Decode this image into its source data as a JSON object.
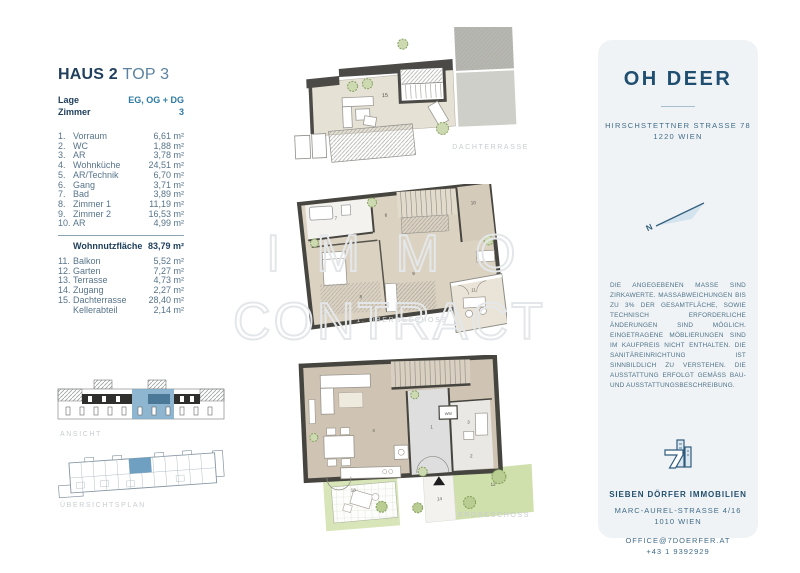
{
  "unit": {
    "title_main": "HAUS 2",
    "title_sub": "TOP 3",
    "info": [
      {
        "label": "Lage",
        "value": "EG, OG + DG"
      },
      {
        "label": "Zimmer",
        "value": "3"
      }
    ],
    "rooms": [
      {
        "no": "1.",
        "name": "Vorraum",
        "area": "6,61 m²"
      },
      {
        "no": "2.",
        "name": "WC",
        "area": "1,88 m²"
      },
      {
        "no": "3.",
        "name": "AR",
        "area": "3,78 m²"
      },
      {
        "no": "4.",
        "name": "Wohnküche",
        "area": "24,51 m²"
      },
      {
        "no": "5.",
        "name": "AR/Technik",
        "area": "6,70 m²"
      },
      {
        "no": "6.",
        "name": "Gang",
        "area": "3,71 m²"
      },
      {
        "no": "7.",
        "name": "Bad",
        "area": "3,89 m²"
      },
      {
        "no": "8.",
        "name": "Zimmer 1",
        "area": "11,19 m²"
      },
      {
        "no": "9.",
        "name": "Zimmer 2",
        "area": "16,53 m²"
      },
      {
        "no": "10.",
        "name": "AR",
        "area": "4,99 m²"
      }
    ],
    "total": {
      "label": "Wohnnutzfläche",
      "area": "83,79 m²"
    },
    "outdoor": [
      {
        "no": "11.",
        "name": "Balkon",
        "area": "5,52 m²"
      },
      {
        "no": "12.",
        "name": "Garten",
        "area": "7,27 m²"
      },
      {
        "no": "13.",
        "name": "Terrasse",
        "area": "4,73 m²"
      },
      {
        "no": "14.",
        "name": "Zugang",
        "area": "2,27 m²"
      },
      {
        "no": "15.",
        "name": "Dachterrasse",
        "area": "28,40 m²"
      },
      {
        "no": "",
        "name": "Kellerabteil",
        "area": "2,14 m²"
      }
    ]
  },
  "drawings": {
    "ansicht_caption": "ANSICHT",
    "uebersichtsplan_caption": "ÜBERSICHTSPLAN"
  },
  "plans": {
    "dachterrasse": {
      "caption": "DACHTERRASSE",
      "labels": [
        "15"
      ]
    },
    "obergeschoss": {
      "caption": "1. OBERGESCHOSS",
      "labels": [
        "6",
        "7",
        "8",
        "9",
        "10",
        "11"
      ]
    },
    "erdgeschoss": {
      "caption": "ERDGESCHOSS",
      "labels": [
        "4",
        "1",
        "3",
        "2",
        "WM",
        "13",
        "14",
        "12"
      ]
    }
  },
  "watermark": {
    "line1": "IMMO",
    "line2": "CONTRACT"
  },
  "agency_card": {
    "project_name": "OH DEER",
    "address_line1": "HIRSCHSTETTNER STRASSE 78",
    "address_line2": "1220 WIEN",
    "compass_label": "N",
    "disclaimer": "DIE ANGEGEBENEN MASSE SIND ZIRKAWERTE. MASSABWEICHUNGEN BIS ZU 3% DER GESAMTFLÄCHE, SOWIE TECHNISCH ERFORDERLICHE ÄNDERUNGEN SIND MÖGLICH. EINGETRAGENE MÖBLIERUNGEN SIND IM KAUFPREIS NICHT ENTHALTEN. DIE SANITÄREINRICHTUNG IST SINNBILDLICH ZU VERSTEHEN. DIE AUSSTATTUNG ERFOLGT GEMÄSS BAU- UND AUSSTATTUNGSBESCHREIBUNG.",
    "company": "SIEBEN DÖRFER IMMOBILIEN",
    "company_address_line1": "MARC-AUREL-STRASSE 4/16",
    "company_address_line2": "1010 WIEN",
    "email": "OFFICE@7DOERFER.AT",
    "phone": "+43 1 9392929"
  },
  "colors": {
    "navy": "#21405d",
    "teal": "#2e7aa3",
    "list_text": "#57748a",
    "caption_gray": "#c8cdd0",
    "card_bg": "#f0f3f5",
    "highlight_blue": "#6fa3c6",
    "plan_wall": "#45443e",
    "plan_beige": "#d9d0c0",
    "garden_green": "#cfe0ac"
  }
}
